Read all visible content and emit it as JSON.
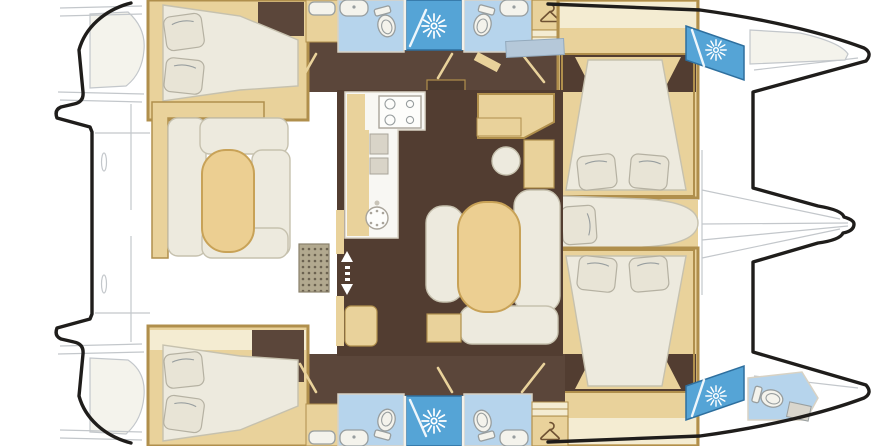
{
  "meta": {
    "title": "Catamaran interior layout floor plan",
    "view": "top-down",
    "visible_text": "none"
  },
  "colors": {
    "background": "#ffffff",
    "hull_outline": "#1f1d1b",
    "deck_line": "#c3c7cb",
    "floor_dark": "#523d31",
    "corridor_brown": "#5b463a",
    "wood_tan": "#e9d29b",
    "wood_light": "#f4ecd2",
    "wood_border": "#b08f4c",
    "counter_white": "#f8f7f3",
    "bath_floor": "#b6d4ec",
    "shower_blue": "#55a4d6",
    "shower_border": "#2e6f9e",
    "fixture_white": "#f4f3ec",
    "fixture_stroke": "#989e9f",
    "cushion": "#edeade",
    "cushion_stroke": "#c6c1ae",
    "pillow": "#e8e4d6",
    "table_tan": "#eccf92",
    "table_border": "#c8a257",
    "window_blue": "#b5c8d9",
    "grate_base": "#b2a98f",
    "grate_dot": "#6b6250",
    "icon_white": "#ffffff",
    "hanger_brown": "#6f5233",
    "step_brown": "#4b392d"
  },
  "rooms": {
    "cockpit": "aft cockpit with U-shaped sofa and table",
    "salon": "salon with dining table, sofa and chair",
    "galley": "galley with stove, fridge and round sink",
    "nav_station": "chart table with round stool",
    "aft_cabin_top": "aft double cabin, upper hull",
    "aft_cabin_bottom": "aft double cabin, lower hull",
    "fwd_cabin_top": "forward double cabin, upper hull",
    "fwd_cabin_bottom": "forward double cabin, lower hull",
    "bathroom": "bathroom with toilet and washbasin",
    "shower": "shower cubicle with sun drain symbol",
    "wardrobe": "wardrobe with clothes hanger symbol",
    "bow_head": "bow toilet compartment",
    "bow_berth": "bow locker berth",
    "fwd_lounge": "forward centre lounge berth",
    "trampoline": "bow trampoline and crossbeam",
    "transom": "twin stern platforms and steps"
  },
  "icons": {
    "shower_sun": "sunburst shower symbol",
    "hanger": "clothes hanger symbol",
    "stove": "four-burner stove",
    "galley_sink": "round sink with drain holes",
    "stairs": "companionway steps",
    "entry_arrows": "up-down entry arrows",
    "floor_grate": "dotted cockpit grate"
  },
  "counts": {
    "double_berths": 4,
    "bathrooms": 4,
    "shower_sun_icons": 4,
    "toilets": 5,
    "hanger_icons": 2,
    "stairways": 2
  }
}
